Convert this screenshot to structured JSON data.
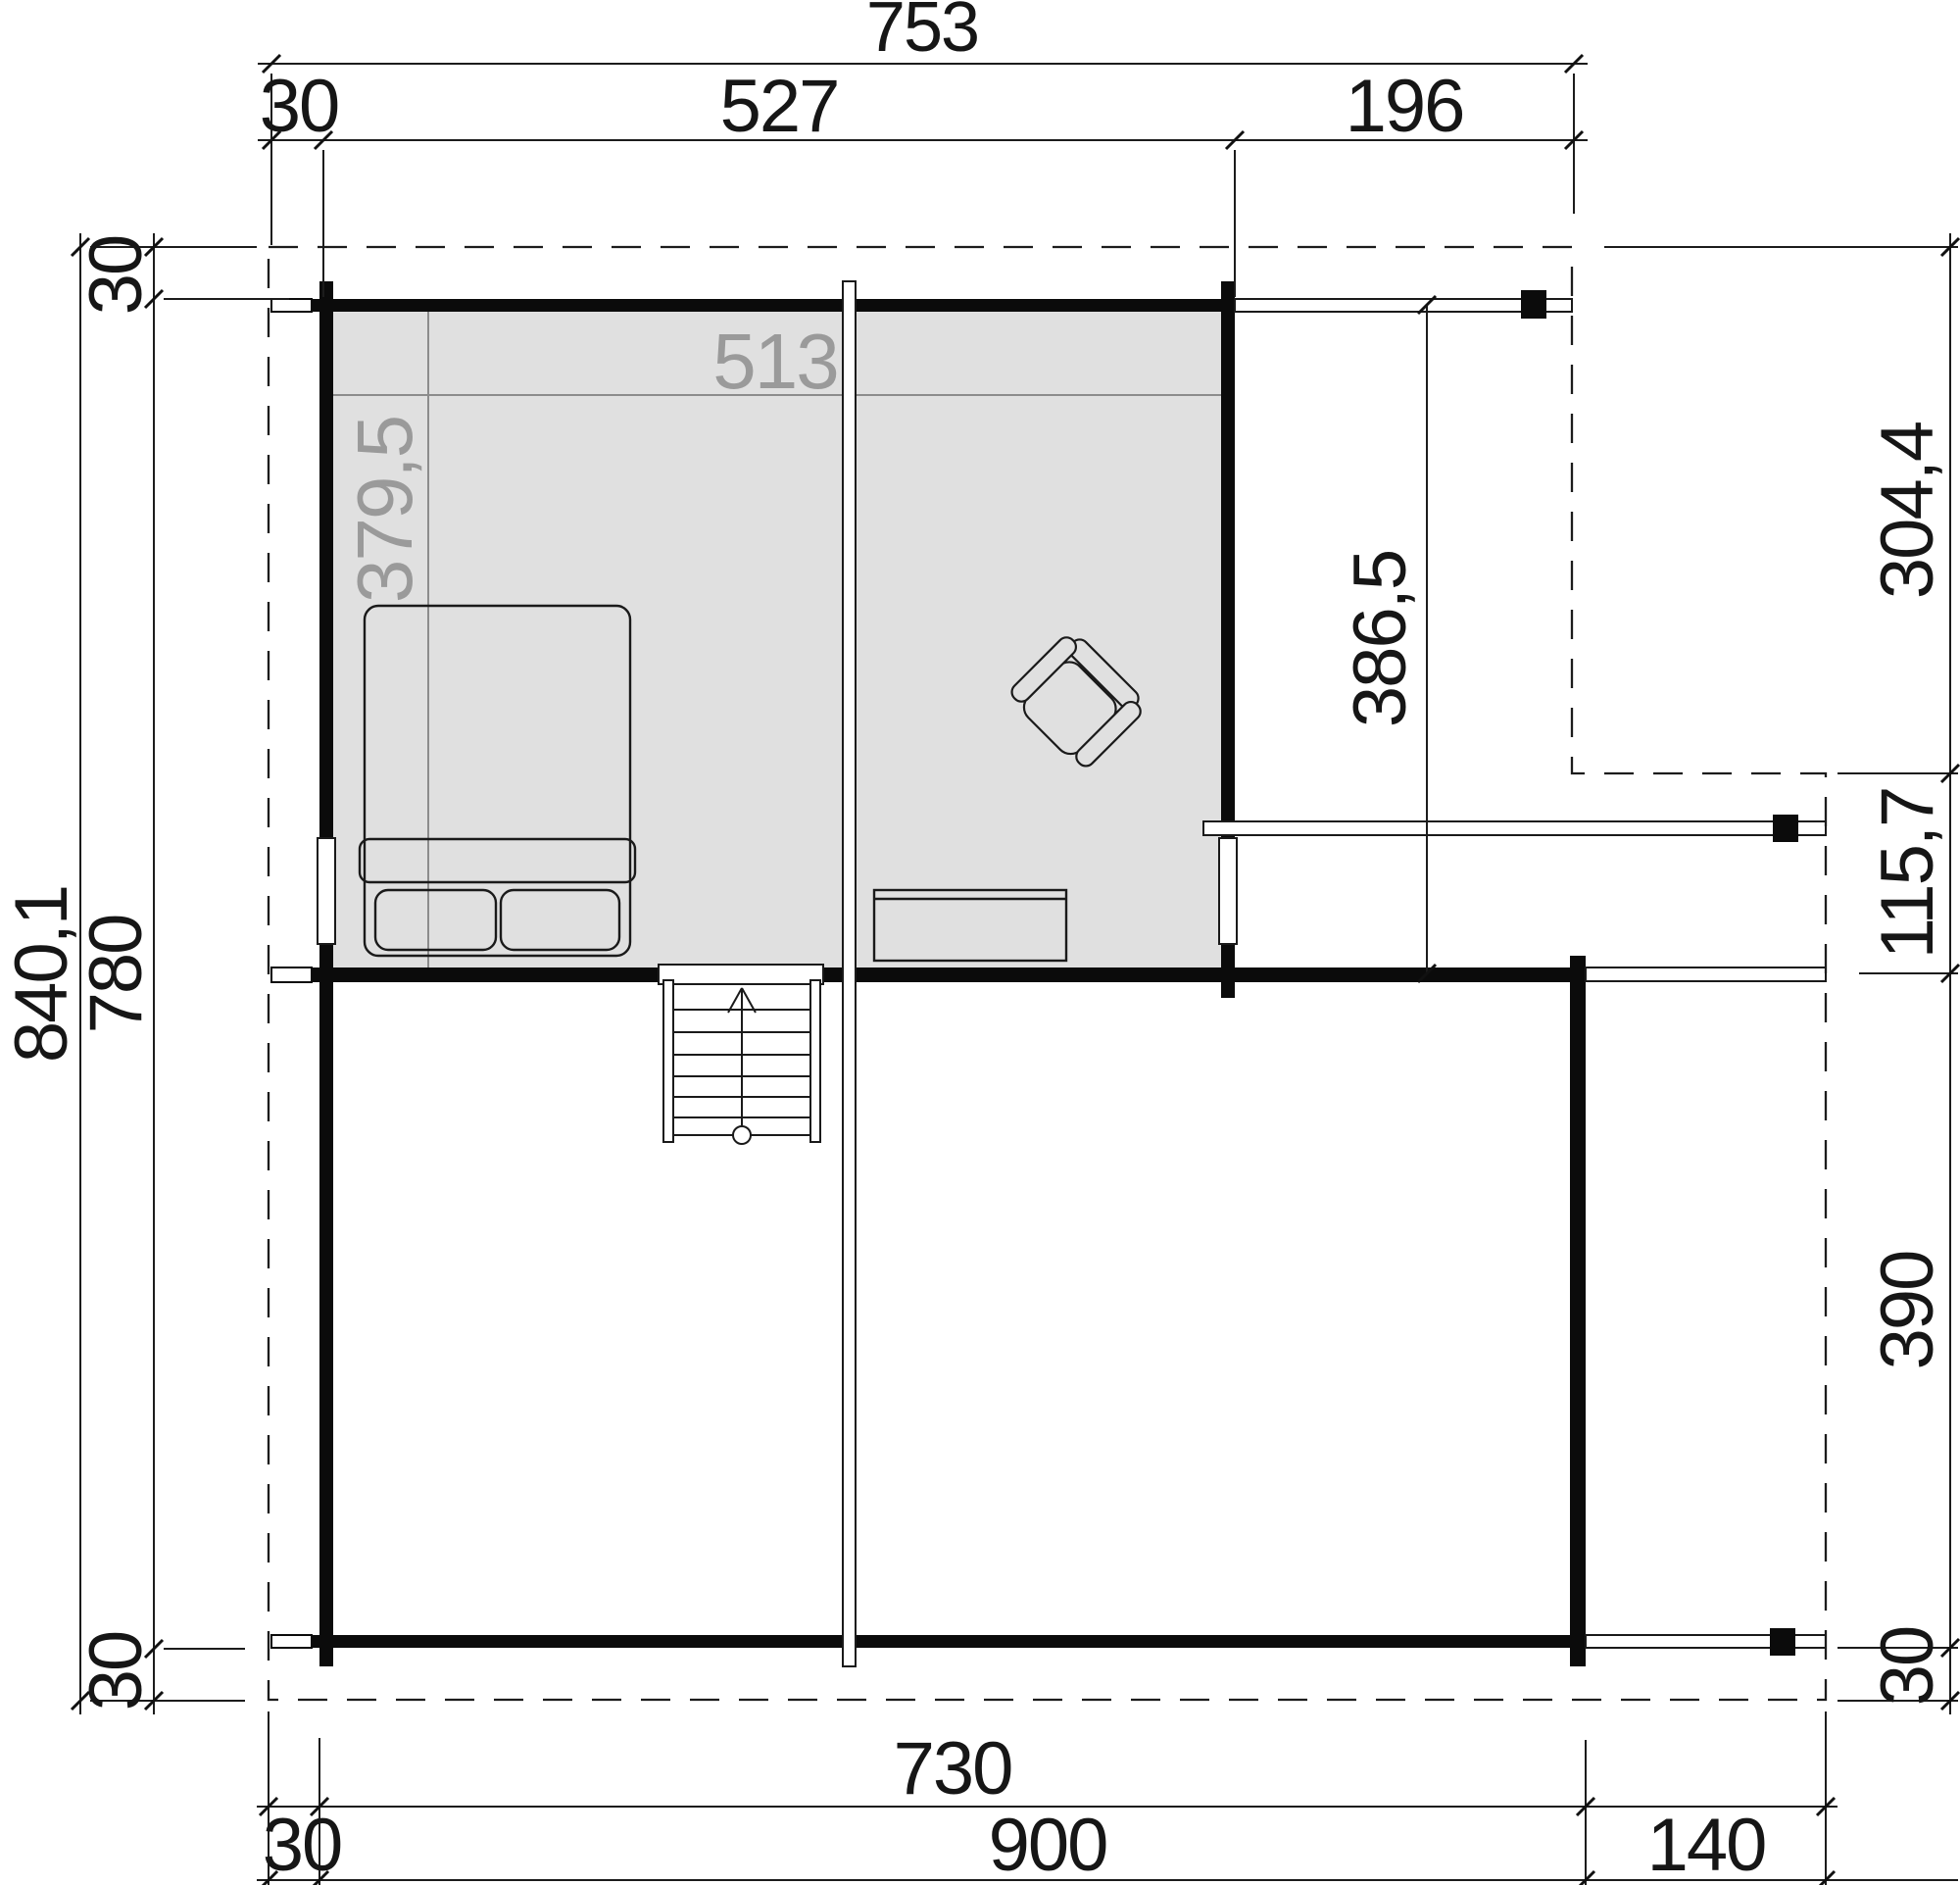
{
  "plan": {
    "type": "floor-plan-upper-storey",
    "colors": {
      "room_fill": "#e0e0e0",
      "wall": "#0b0b0b",
      "line": "#1c1c1c",
      "gray_label": "#9a9a9a",
      "background": "#ffffff"
    },
    "dims": {
      "top": {
        "overall": "753",
        "s1": "30",
        "s2": "527",
        "s3": "196"
      },
      "left": {
        "overall": "840,1",
        "t": "30",
        "mid": "780",
        "b": "30"
      },
      "right": {
        "r1": "304,4",
        "r2": "115,7",
        "r3": "390",
        "r4": "30"
      },
      "bottom": {
        "building": "730",
        "b1": "30",
        "b2": "900",
        "b3": "140"
      },
      "inner": {
        "width": "513",
        "depth": "379,5",
        "terrace": "386,5"
      }
    }
  }
}
